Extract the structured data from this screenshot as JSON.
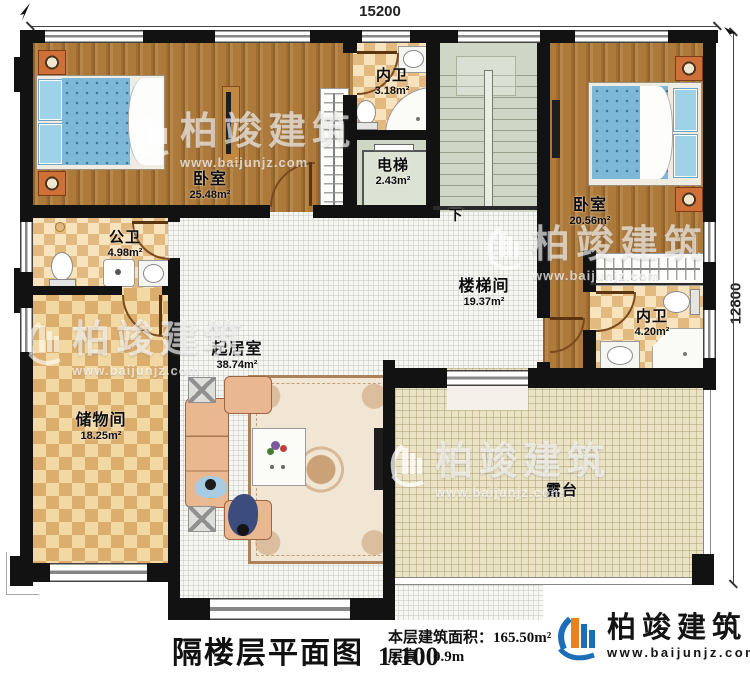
{
  "plan": {
    "dim_top": "15200",
    "dim_right": "12800",
    "stairs_down": "下"
  },
  "rooms": [
    {
      "name": "卧室",
      "area": "25.48m²"
    },
    {
      "name": "内卫",
      "area": "3.18m²"
    },
    {
      "name": "电梯",
      "area": "2.43m²"
    },
    {
      "name": "卧室",
      "area": "20.56m²"
    },
    {
      "name": "公卫",
      "area": "4.98m²"
    },
    {
      "name": "楼梯间",
      "area": "19.37m²"
    },
    {
      "name": "内卫",
      "area": "4.20m²"
    },
    {
      "name": "起居室",
      "area": "38.74m²"
    },
    {
      "name": "储物间",
      "area": "18.25m²"
    },
    {
      "name": "露台",
      "area": ""
    }
  ],
  "title_block": {
    "title": "隔楼层平面图",
    "scale": "1:100",
    "building_area": "本层建筑面积：165.50m²",
    "floor_height": "层高：0.9m"
  },
  "branding": {
    "name": "柏竣建筑",
    "url": "www.baijunjz.com"
  },
  "watermark": {
    "name": "柏竣建筑",
    "url": "www.baijunjz.com"
  },
  "colors": {
    "wall": "#121212",
    "wood": "#ad7a3c",
    "tile_light": "#f7e3bd",
    "tile_dark": "#e2b97f",
    "stairs": "#cfd6c6",
    "terrace": "#ebe3c6",
    "brand_blue": "#1e6eb5",
    "brand_orange": "#e8821e"
  }
}
